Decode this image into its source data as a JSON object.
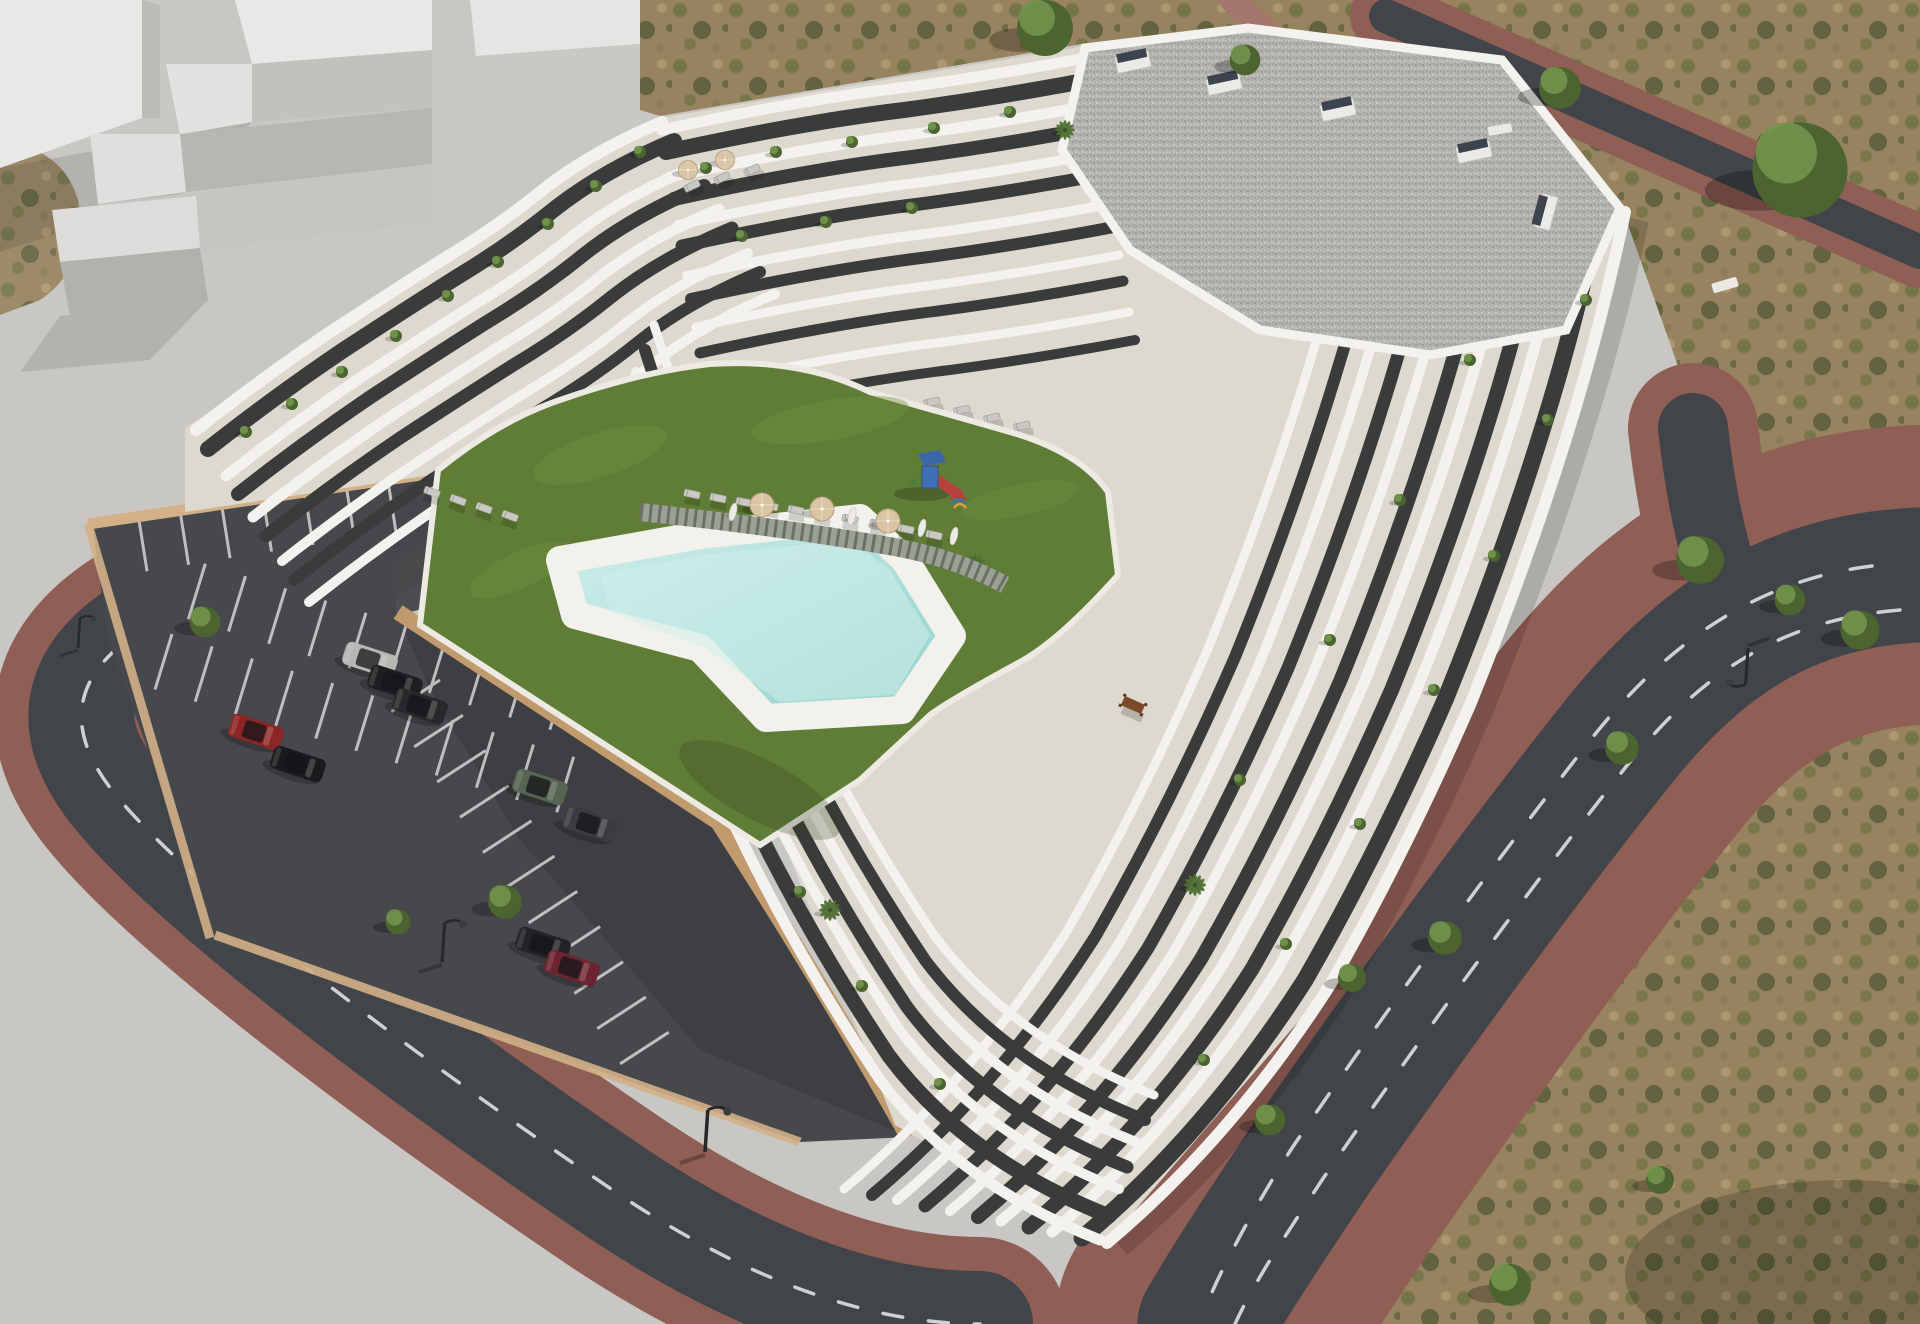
{
  "meta": {
    "description": "Aerial daytime 3D architectural rendering of a white terraced apartment complex with organic curved balconies around a raised courtyard containing a lawn, free-form swimming pool, timber walkway, sun loungers, parasols and a small playground; an asphalt car park with marked stalls and parked cars sits lower-left behind beige retaining walls; plain white massing blocks of neighbouring buildings occupy the upper-left on grey concrete; ring roads with dashed white lane markings and red-brick paved sidewalks wrap the block; dry scrubland with green trees fills the right and top-right. No text, labels or UI elements are visible."
  },
  "palette": {
    "concrete": "#c9c7c3",
    "massing_light": "#e9e8e6",
    "massing_mid": "#c2c1be",
    "massing_shadow": "#b2b1ae",
    "dirt": "#97835f",
    "scrub": "#6d7342",
    "scrub_dark": "#4c5732",
    "road": "#414449",
    "road_line": "#e9e9e7",
    "brick": "#8f5e55",
    "brick_light": "#a4776c",
    "parking": "#46484c",
    "stall_line": "#dededd",
    "wall_beige": "#d3b088",
    "wall_beige_dark": "#c19a6e",
    "building_white": "#f3f2ee",
    "terrace_floor": "#ddd9cf",
    "facade_dark": "#393c3a",
    "facade_darker": "#2b2e2d",
    "roof_gravel": "#b3b2ae",
    "roof_speck_dark": "#8e8d89",
    "roof_speck_light": "#d6d5d1",
    "chimney_top": "#3d4450",
    "lawn": "#5f7d36",
    "lawn_light": "#729140",
    "pool_light": "#d2efec",
    "pool": "#aedfdb",
    "pool_deep": "#93cfca",
    "pool_deck": "#f2f1ec",
    "walkway": "#9aa093",
    "walkway_gap": "#4c5046",
    "umbrella_tan": "#d9c5a3",
    "umbrella_white": "#eceae4",
    "lounger": "#c9c8c3",
    "play_blue": "#3f6fb5",
    "play_red": "#b5433c",
    "play_green": "#4a7d3c",
    "play_yellow": "#d8a13a",
    "tree": "#72934c",
    "tree_dark": "#4c642f",
    "table_wood": "#7a4a2a"
  },
  "scene": {
    "setting": "daytime aerial view, sun from the upper right, soft shadows cast toward lower left",
    "building": {
      "style": "white organic wavy terraced balconies stacked over dark anthracite glazed facades",
      "roof": "flat gravel roof with dark-topped vent boxes",
      "courtyard_features": [
        "green lawn",
        "free-form swimming pool with white deck",
        "timber plank walkway",
        "rows of sun loungers",
        "parasols",
        "children's playground with slide"
      ]
    },
    "parking": {
      "surface": "dark asphalt with white stall markings",
      "enclosure": "beige retaining walls",
      "cars_parked": 9
    },
    "cars": [
      {
        "label": "silver sedan",
        "color": "#b7b6b2"
      },
      {
        "label": "black sedan",
        "color": "#1d1f21"
      },
      {
        "label": "black sedan",
        "color": "#26282a"
      },
      {
        "label": "red hatchback",
        "color": "#8c2624"
      },
      {
        "label": "black hatchback",
        "color": "#191b1d"
      },
      {
        "label": "green off-road SUV",
        "color": "#556552"
      },
      {
        "label": "dark grey sedan",
        "color": "#3a3c40"
      },
      {
        "label": "black SUV",
        "color": "#212326"
      },
      {
        "label": "dark red hatchback",
        "color": "#6e2430"
      }
    ],
    "counts": {
      "cars": 9,
      "parasols_open": 5,
      "parasols_closed": 4,
      "sun_loungers": 21,
      "street_trees": 7,
      "field_trees": 8,
      "roof_vents": 5,
      "street_lamps": 4,
      "terrace_tables": 2,
      "outdoor_sofas": 2,
      "palms": 4,
      "playgrounds": 1,
      "pools": 1
    },
    "regions": [
      {
        "name": "massing-blocks",
        "desc": "plain white neighbouring building volumes on grey concrete, upper left"
      },
      {
        "name": "apartment-building",
        "desc": "central white terraced complex with gravel roof at top right"
      },
      {
        "name": "courtyard",
        "desc": "raised podium with lawn, pool, walkway, loungers, parasols, playground"
      },
      {
        "name": "parking-lot",
        "desc": "asphalt car park with white stalls and nine cars, lower left"
      },
      {
        "name": "streets",
        "desc": "asphalt roads with dashed white markings and red-brick sidewalks wrapping the block"
      },
      {
        "name": "scrubland",
        "desc": "dry patchy ground with green trees, top right and bottom right"
      }
    ]
  }
}
